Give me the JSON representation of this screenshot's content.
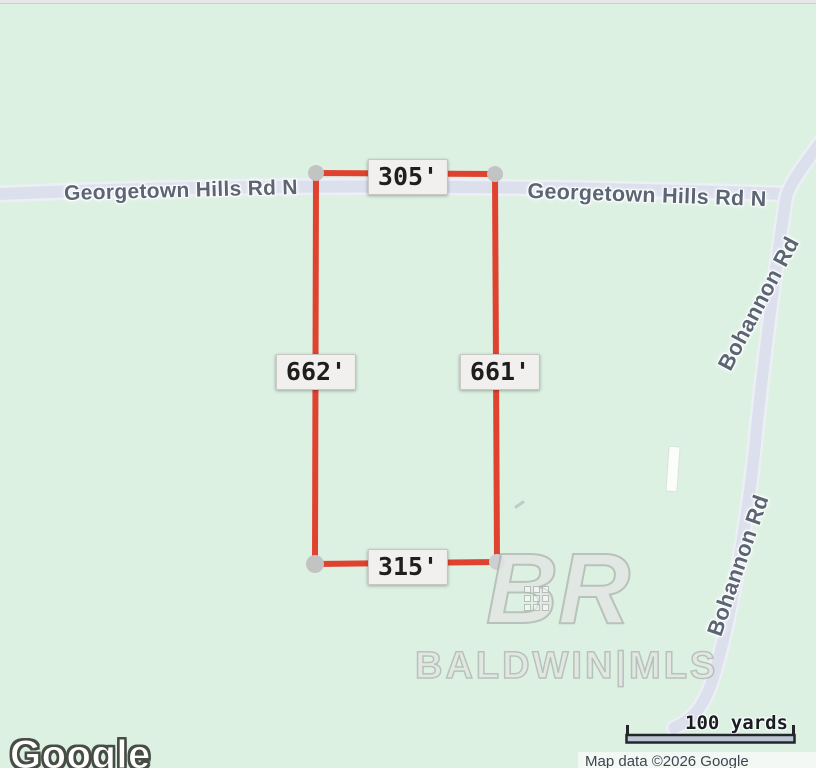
{
  "colors": {
    "background": "#ddf1e3",
    "road_fill": "#dce0ed",
    "road_casing": "#edeff6",
    "parcel_stroke": "#df4330",
    "vertex_fill": "#c2c4c4",
    "label_box_bg": "#f1f0ee",
    "label_box_border": "#c8c6c2",
    "road_label_text": "#5b6573",
    "scale_text": "#1a1e24",
    "attribution_bg": "#f3f8f4",
    "attribution_text": "#3d4650"
  },
  "roads": {
    "georgetown_left": "Georgetown Hills Rd N",
    "georgetown_right": "Georgetown Hills Rd N",
    "bohannon_upper": "Bohannon Rd",
    "bohannon_lower": "Bohannon Rd"
  },
  "parcel": {
    "measurements": {
      "top": "305'",
      "left": "662'",
      "right": "661'",
      "bottom": "315'"
    }
  },
  "watermark": {
    "logo_letter_b": "B",
    "logo_letter_r": "R",
    "name": "BALDWIN|MLS"
  },
  "footer": {
    "google_logo": "Google",
    "scale_label": "100 yards",
    "attribution": "Map data ©2026 Google"
  }
}
